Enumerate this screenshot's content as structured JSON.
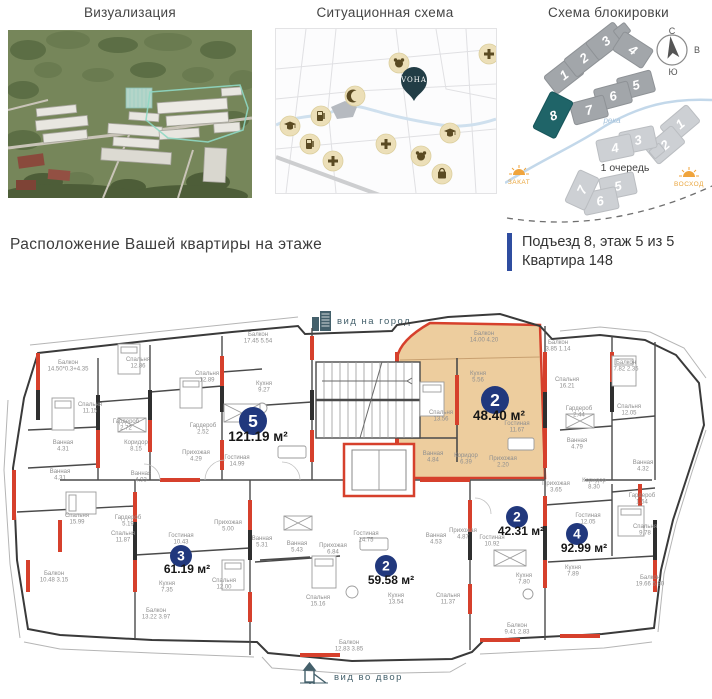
{
  "panels": {
    "visualization": {
      "title": "Визуализация"
    },
    "situation": {
      "title": "Ситуационная схема",
      "logo": "VOHA",
      "pois": [
        {
          "icon": "kindergarten-icon",
          "x": 123,
          "y": 34
        },
        {
          "icon": "pharmacy-icon",
          "x": 213,
          "y": 25
        },
        {
          "icon": "mosque-icon",
          "x": 79,
          "y": 67
        },
        {
          "icon": "fuel-icon",
          "x": 45,
          "y": 87
        },
        {
          "icon": "school-icon",
          "x": 14,
          "y": 97
        },
        {
          "icon": "fuel-icon",
          "x": 34,
          "y": 115
        },
        {
          "icon": "pharmacy-icon",
          "x": 57,
          "y": 132
        },
        {
          "icon": "hospital-icon",
          "x": 110,
          "y": 115
        },
        {
          "icon": "kindergarten-icon",
          "x": 145,
          "y": 127
        },
        {
          "icon": "school-icon",
          "x": 174,
          "y": 104
        },
        {
          "icon": "shop-icon",
          "x": 166,
          "y": 145
        }
      ],
      "pin": {
        "x": 138,
        "y": 72
      }
    },
    "blocking": {
      "title": "Схема блокировки",
      "compass": {
        "north": "С",
        "east": "В",
        "south": "Ю",
        "west": "З"
      },
      "river_label": "река",
      "phase_label": "1 очередь",
      "sunset_label": "ЗАКАТ",
      "sunrise_label": "ВОСХОД",
      "blocks_phase2": [
        {
          "n": "1",
          "x": 59,
          "y": 49,
          "r": -38
        },
        {
          "n": "2",
          "x": 79,
          "y": 32,
          "r": -38
        },
        {
          "n": "3",
          "x": 101,
          "y": 15,
          "r": -38
        },
        {
          "n": "",
          "x": 117,
          "y": 5,
          "r": -38,
          "w": 13,
          "h": 10
        },
        {
          "n": "4",
          "x": 128,
          "y": 24,
          "r": 33
        },
        {
          "n": "5",
          "x": 131,
          "y": 59,
          "r": -15
        },
        {
          "n": "6",
          "x": 108,
          "y": 70,
          "r": -15
        },
        {
          "n": "7",
          "x": 84,
          "y": 84,
          "r": -15
        },
        {
          "n": "8",
          "x": 48,
          "y": 89,
          "r": -63,
          "w": 40,
          "h": 24,
          "hl": true
        }
      ],
      "blocks_phase1": [
        {
          "n": "1",
          "x": 175,
          "y": 98,
          "r": -40
        },
        {
          "n": "2",
          "x": 160,
          "y": 119,
          "r": -40
        },
        {
          "n": "",
          "x": 152,
          "y": 125,
          "r": -40,
          "w": 12,
          "h": 9
        },
        {
          "n": "3",
          "x": 133,
          "y": 114,
          "r": -12
        },
        {
          "n": "4",
          "x": 110,
          "y": 122,
          "r": -12
        },
        {
          "n": "5",
          "x": 113,
          "y": 160,
          "r": -12
        },
        {
          "n": "6",
          "x": 95,
          "y": 175,
          "r": -12
        },
        {
          "n": "7",
          "x": 77,
          "y": 164,
          "r": -65
        }
      ]
    }
  },
  "location": {
    "heading": "Расположение Вашей квартиры на этаже",
    "entrance": "Подъезд 8, этаж 5 из 5",
    "apartment": "Квартира 148"
  },
  "floorplan": {
    "view_city": "вид на город",
    "view_yard": "вид во двор",
    "badge_color": "#21387d",
    "apartments": [
      {
        "n": "5",
        "area": "121.19 м²",
        "x": 253,
        "y": 421,
        "r": 14,
        "ax": 258,
        "ay": 441,
        "big": true
      },
      {
        "n": "2",
        "area": "48.40 м²",
        "x": 495,
        "y": 400,
        "r": 14,
        "ax": 499,
        "ay": 420,
        "big": true
      },
      {
        "n": "2",
        "area": "42.31 м²",
        "x": 517,
        "y": 517,
        "r": 11,
        "ax": 521,
        "ay": 535
      },
      {
        "n": "4",
        "area": "92.99 м²",
        "x": 577,
        "y": 534,
        "r": 11,
        "ax": 584,
        "ay": 552
      },
      {
        "n": "3",
        "area": "61.19 м²",
        "x": 181,
        "y": 556,
        "r": 11,
        "ax": 187,
        "ay": 573
      },
      {
        "n": "2",
        "area": "59.58 м²",
        "x": 386,
        "y": 566,
        "r": 11,
        "ax": 391,
        "ay": 584
      }
    ],
    "rooms": [
      {
        "t": "Балкон",
        "d": "17.45  5.54",
        "x": 258,
        "y": 336
      },
      {
        "t": "Балкон",
        "d": "14.50*0.3+4.35",
        "x": 68,
        "y": 364
      },
      {
        "t": "Спальня",
        "d": "12.86",
        "x": 138,
        "y": 361
      },
      {
        "t": "Спальня",
        "d": "12.89",
        "x": 207,
        "y": 375
      },
      {
        "t": "Спальня",
        "d": "11.15",
        "x": 90,
        "y": 406
      },
      {
        "t": "Гардероб",
        "d": "2.72",
        "x": 126,
        "y": 423
      },
      {
        "t": "Коридор",
        "d": "8.15",
        "x": 136,
        "y": 444
      },
      {
        "t": "Ванная",
        "d": "4.31",
        "x": 63,
        "y": 444
      },
      {
        "t": "Ванная",
        "d": "4.31",
        "x": 60,
        "y": 473
      },
      {
        "t": "Ванная",
        "d": "4.93",
        "x": 141,
        "y": 475
      },
      {
        "t": "Прихожая",
        "d": "4.29",
        "x": 196,
        "y": 454
      },
      {
        "t": "Гостиная",
        "d": "14.99",
        "x": 237,
        "y": 459
      },
      {
        "t": "Гардероб",
        "d": "2.52",
        "x": 203,
        "y": 427
      },
      {
        "t": "Кухня",
        "d": "9.27",
        "x": 264,
        "y": 385
      },
      {
        "t": "Балкон",
        "d": "14.00  4.20",
        "x": 484,
        "y": 335
      },
      {
        "t": "Кухня",
        "d": "5.56",
        "x": 478,
        "y": 375
      },
      {
        "t": "Спальня",
        "d": "13.56",
        "x": 441,
        "y": 414
      },
      {
        "t": "Гостиная",
        "d": "11.67",
        "x": 517,
        "y": 425
      },
      {
        "t": "Ванная",
        "d": "4.84",
        "x": 433,
        "y": 455
      },
      {
        "t": "Коридор",
        "d": "6.39",
        "x": 466,
        "y": 457
      },
      {
        "t": "Прихожая",
        "d": "2.20",
        "x": 503,
        "y": 460
      },
      {
        "t": "Балкон",
        "d": "3.85  1.14",
        "x": 558,
        "y": 344
      },
      {
        "t": "Спальня",
        "d": "16.21",
        "x": 567,
        "y": 381
      },
      {
        "t": "Гардероб",
        "d": "2.44",
        "x": 579,
        "y": 410
      },
      {
        "t": "Ванная",
        "d": "4.79",
        "x": 577,
        "y": 442
      },
      {
        "t": "Балкон",
        "d": "7.82  2.35",
        "x": 626,
        "y": 364
      },
      {
        "t": "Спальня",
        "d": "12.05",
        "x": 629,
        "y": 408
      },
      {
        "t": "Ванная",
        "d": "4.32",
        "x": 643,
        "y": 464
      },
      {
        "t": "Прихожая",
        "d": "3.65",
        "x": 556,
        "y": 485
      },
      {
        "t": "Коридор",
        "d": "8.30",
        "x": 594,
        "y": 482
      },
      {
        "t": "Гардероб",
        "d": "1.54",
        "x": 642,
        "y": 497
      },
      {
        "t": "Спальня",
        "d": "9.78",
        "x": 645,
        "y": 528
      },
      {
        "t": "Гостиная",
        "d": "12.05",
        "x": 588,
        "y": 517
      },
      {
        "t": "Кухня",
        "d": "7.89",
        "x": 573,
        "y": 569
      },
      {
        "t": "Балкон",
        "d": "19.66  5.90",
        "x": 650,
        "y": 579
      },
      {
        "t": "Гостиная",
        "d": "10.92",
        "x": 492,
        "y": 539
      },
      {
        "t": "Кухня",
        "d": "7.80",
        "x": 524,
        "y": 577
      },
      {
        "t": "Балкон",
        "d": "9.41  2.83",
        "x": 517,
        "y": 627
      },
      {
        "t": "Спальня",
        "d": "15.99",
        "x": 77,
        "y": 517
      },
      {
        "t": "Гардероб",
        "d": "5.19",
        "x": 128,
        "y": 519
      },
      {
        "t": "Спальня",
        "d": "11.87",
        "x": 123,
        "y": 535
      },
      {
        "t": "Гостиная",
        "d": "10.43",
        "x": 181,
        "y": 537
      },
      {
        "t": "Прихожая",
        "d": "5.00",
        "x": 228,
        "y": 524
      },
      {
        "t": "Балкон",
        "d": "10.48  3.15",
        "x": 54,
        "y": 575
      },
      {
        "t": "Кухня",
        "d": "7.35",
        "x": 167,
        "y": 585
      },
      {
        "t": "Спальня",
        "d": "12.00",
        "x": 224,
        "y": 582
      },
      {
        "t": "Балкон",
        "d": "13.22  3.97",
        "x": 156,
        "y": 612
      },
      {
        "t": "Ванная",
        "d": "5.31",
        "x": 262,
        "y": 540
      },
      {
        "t": "Ванная",
        "d": "5.43",
        "x": 297,
        "y": 545
      },
      {
        "t": "Прихожая",
        "d": "6.84",
        "x": 333,
        "y": 547
      },
      {
        "t": "Гостиная",
        "d": "14.75",
        "x": 366,
        "y": 535
      },
      {
        "t": "Спальня",
        "d": "15.16",
        "x": 318,
        "y": 599
      },
      {
        "t": "Кухня",
        "d": "13.54",
        "x": 396,
        "y": 597
      },
      {
        "t": "Ванная",
        "d": "4.53",
        "x": 436,
        "y": 537
      },
      {
        "t": "Прихожая",
        "d": "4.87",
        "x": 463,
        "y": 532
      },
      {
        "t": "Спальня",
        "d": "11.37",
        "x": 448,
        "y": 597
      },
      {
        "t": "Балкон",
        "d": "12.83  3.85",
        "x": 349,
        "y": 644
      }
    ]
  }
}
